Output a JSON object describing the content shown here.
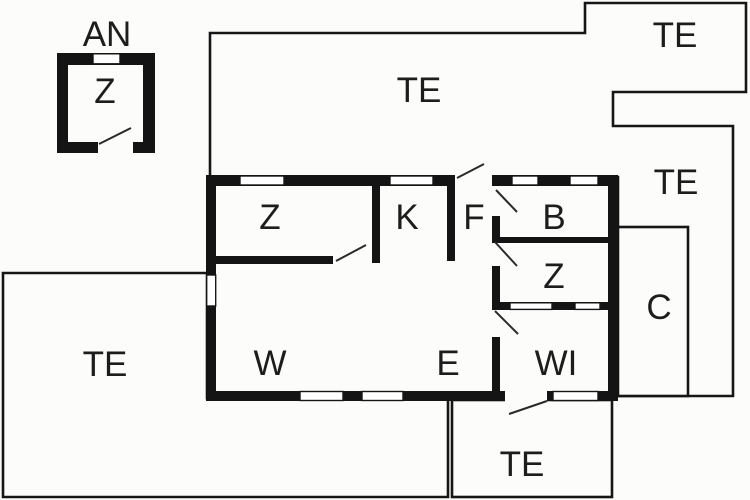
{
  "title": "floor-plan",
  "colors": {
    "background": "#fcfcfb",
    "wall": "#141414",
    "thin_line": "#161616",
    "text": "#1d1d1d"
  },
  "annex": {
    "title_label": "AN",
    "room_label": "Z"
  },
  "terraces": {
    "top_label": "TE",
    "top_right_label": "TE",
    "right_label": "TE",
    "left_label": "TE",
    "bottom_label": "TE"
  },
  "house": {
    "rooms": {
      "z_top_left": "Z",
      "kitchen": "K",
      "foyer": "F",
      "bath": "B",
      "z_right": "Z",
      "living": "W",
      "entry_hall": "E",
      "wi_room": "WI"
    }
  },
  "carport": {
    "label": "C"
  }
}
